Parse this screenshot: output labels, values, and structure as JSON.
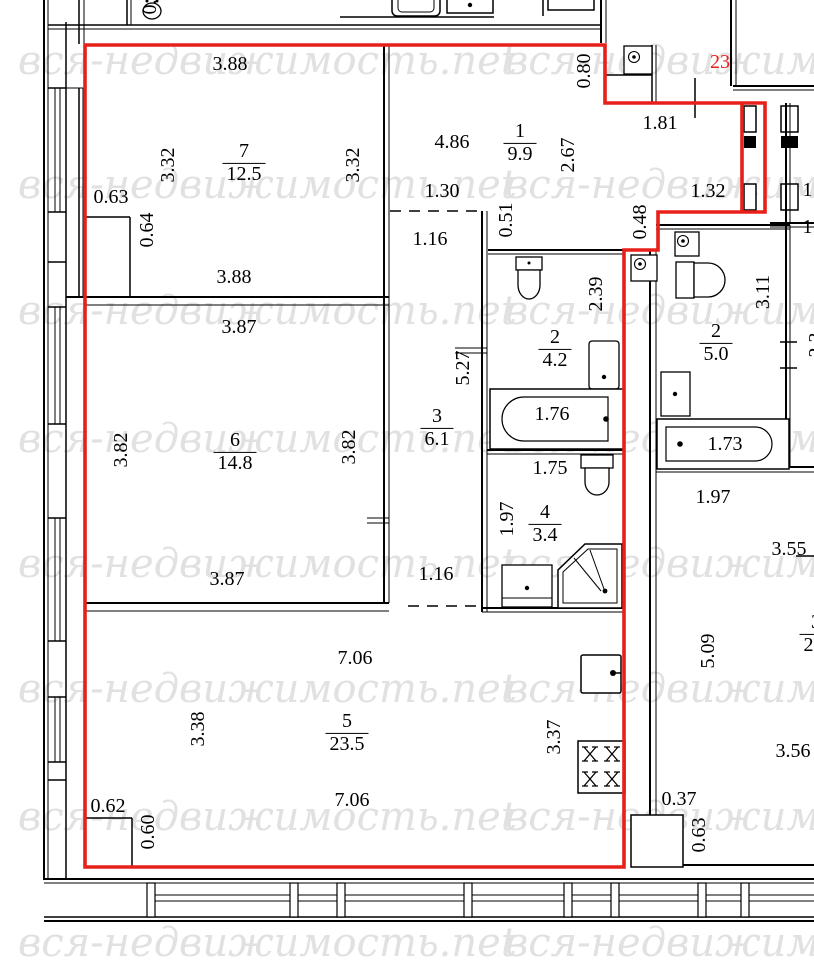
{
  "watermark": {
    "text": "вся-недвижимость.net"
  },
  "apartment": {
    "number": "23"
  },
  "colors": {
    "boundary": "#e8201a",
    "walls": "#000000",
    "watermark": "#e1e1e1"
  },
  "rooms": {
    "room7": {
      "number": "7",
      "area": "12.5"
    },
    "room6": {
      "number": "6",
      "area": "14.8"
    },
    "room5": {
      "number": "5",
      "area": "23.5"
    },
    "hall1": {
      "number": "1",
      "area": "9.9"
    },
    "bath2": {
      "number": "2",
      "area": "4.2"
    },
    "corridor3": {
      "number": "3",
      "area": "6.1"
    },
    "wc4": {
      "number": "4",
      "area": "3.4"
    },
    "bath2_right": {
      "number": "2",
      "area": "5.0"
    },
    "room3_right": {
      "number": "3",
      "area": "22."
    }
  },
  "dims": {
    "d388_top": "3.88",
    "d332_left": "3.32",
    "d332_right": "3.32",
    "d063_niche": "0.63",
    "d064_niche": "0.64",
    "d388_bottom": "3.88",
    "d387_top": "3.87",
    "d382_left": "3.82",
    "d382_right": "3.82",
    "d387_bottom": "3.87",
    "d706_top": "7.06",
    "d338_left": "3.38",
    "d706_bottom": "7.06",
    "d062_niche": "0.62",
    "d060_niche": "0.60",
    "d337_right": "3.37",
    "d486_hall": "4.86",
    "d130_opening": "1.30",
    "d116_top": "1.16",
    "d051_step": "0.51",
    "d080_entry": "0.80",
    "d267_hall": "2.67",
    "d181_entry": "1.81",
    "d132_entry": "1.32",
    "d048_step": "0.48",
    "d239_bath": "2.39",
    "d527_corridor": "5.27",
    "d176_tub": "1.76",
    "d311_bath_right": "3.11",
    "d173_tub_right": "1.73",
    "d175_wc": "1.75",
    "d197_wc_left": "1.97",
    "d116_bottom": "1.16",
    "d197_bath_right": "1.97",
    "d355_room3r": "3.55",
    "d509_room3r": "5.09",
    "d356_room3r": "3.56",
    "d037_jog": "0.37",
    "d063_jog": "0.63",
    "cut_top": "0.38",
    "cut_right_a": "1.",
    "cut_right_b": "1.",
    "cut_right_c": "2.3"
  }
}
